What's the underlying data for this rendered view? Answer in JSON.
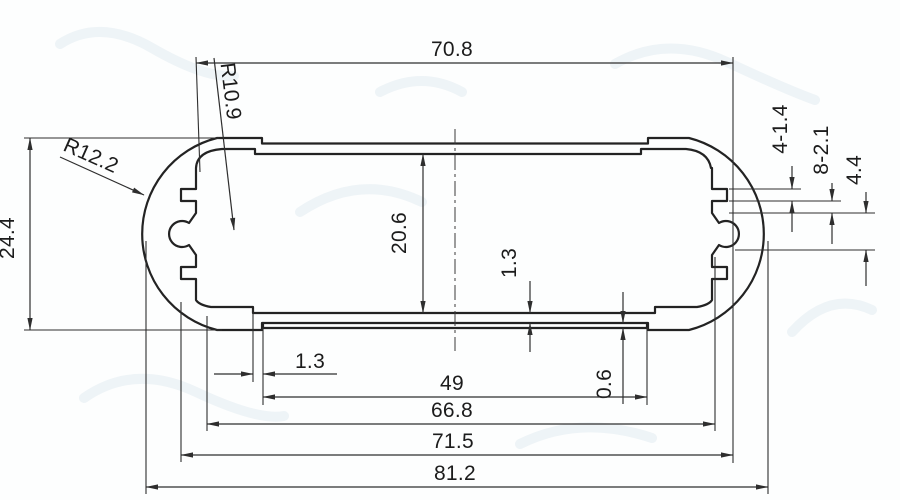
{
  "drawing": {
    "type": "technical-cross-section",
    "labels": {
      "top_width": "70.8",
      "inner_corner_radius": "R10.9",
      "end_radius": "R12.2",
      "overall_height": "24.4",
      "inner_height": "20.6",
      "wall_thickness": "1.3",
      "slot_spec": "4-1.4",
      "tooth_spec": "8-2.1",
      "boss_offset": "4.4",
      "bottom_step_width": "1.3",
      "bottom_step_depth": "0.6",
      "panel_width": "49",
      "inner_width": "66.8",
      "slot_outer_width": "71.5",
      "overall_width": "81.2"
    },
    "colors": {
      "profile_line": "#232323",
      "dimension_line": "#2e2e2e",
      "text": "#1c1c1c",
      "background": "#fdfefe",
      "watermark": "#e4ecf2"
    }
  }
}
